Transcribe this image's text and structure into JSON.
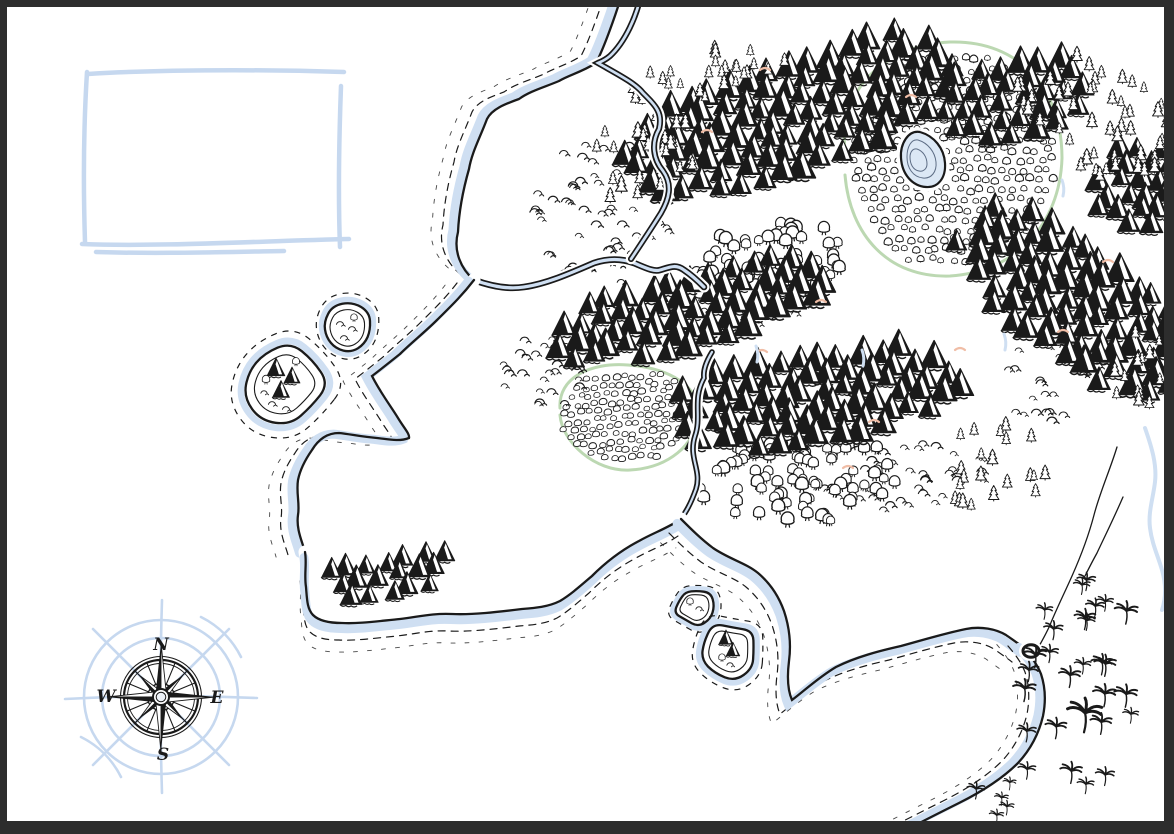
{
  "colors": {
    "ink": "#1a1a1a",
    "paper": "#ffffff",
    "water": "#cfdff2",
    "sketch_blue": "#c6d8ef",
    "green": "#bcd8b2",
    "peach": "#f0bda6",
    "frame": "#2d2d2d",
    "lake_fill": "#dce8f5",
    "lake_line": "#5d6d85"
  },
  "compass": {
    "cx": 161,
    "cy": 697,
    "labels": {
      "n": "N",
      "e": "E",
      "s": "S",
      "w": "W"
    }
  },
  "legend_box": {
    "strokes": [
      "M 88,74 C 150,70 250,69 344,72",
      "M 87,72 C 84,120 83,180 85,242",
      "M 341,86 C 339,140 338,195 340,247",
      "M 82,244 C 160,247 260,241 349,239",
      "M 96,252 C 160,254 220,252 284,251"
    ]
  },
  "map": {
    "green_outlines": [
      "M 845,150 C 838,90 885,45 950,42 C 1020,40 1062,90 1062,158 C 1060,225 1015,272 950,276 C 888,278 850,235 845,175",
      "M 560,408 C 558,378 590,362 628,365 C 668,368 700,385 698,415 C 696,445 668,468 630,470 C 595,472 562,442 560,415"
    ],
    "terrain": [
      {
        "name": "forest-round",
        "glyph": "bush",
        "cx": 952,
        "cy": 160,
        "rx": 103,
        "ry": 110,
        "rot": 0,
        "mode": "grid",
        "su": 11,
        "sv": 10,
        "s": 1,
        "seed": 52
      },
      {
        "name": "boulder-field",
        "glyph": "boulder",
        "cx": 628,
        "cy": 416,
        "rx": 68,
        "ry": 47,
        "rot": -5,
        "mode": "grid",
        "su": 9,
        "sv": 8,
        "s": 1,
        "seed": 51
      },
      {
        "name": "scrub-northwest",
        "glyph": "scrub",
        "cx": 602,
        "cy": 210,
        "rx": 72,
        "ry": 75,
        "rot": 0,
        "mode": "rand",
        "count": 55,
        "s": 1,
        "seed": 41
      },
      {
        "name": "scrub-west",
        "glyph": "scrub",
        "cx": 545,
        "cy": 368,
        "rx": 46,
        "ry": 42,
        "rot": 0,
        "mode": "rand",
        "count": 26,
        "s": 1,
        "seed": 42
      },
      {
        "name": "scrub-south",
        "glyph": "scrub",
        "cx": 905,
        "cy": 478,
        "rx": 85,
        "ry": 34,
        "rot": -8,
        "mode": "rand",
        "count": 40,
        "s": 1,
        "seed": 43
      },
      {
        "name": "scrub-east",
        "glyph": "scrub",
        "cx": 1048,
        "cy": 372,
        "rx": 55,
        "ry": 48,
        "rot": 0,
        "mode": "rand",
        "count": 26,
        "s": 1,
        "seed": 44
      },
      {
        "name": "scrub-mid",
        "glyph": "scrub",
        "cx": 757,
        "cy": 300,
        "rx": 60,
        "ry": 24,
        "rot": -8,
        "mode": "rand",
        "count": 16,
        "s": 1,
        "seed": 45
      },
      {
        "name": "grove-north",
        "glyph": "tree",
        "cx": 762,
        "cy": 262,
        "rx": 88,
        "ry": 38,
        "rot": -8,
        "mode": "rand",
        "count": 55,
        "s": 1.1,
        "seed": 31
      },
      {
        "name": "grove-central",
        "glyph": "tree",
        "cx": 800,
        "cy": 480,
        "rx": 100,
        "ry": 46,
        "rot": -6,
        "mode": "rand",
        "count": 85,
        "s": 1.1,
        "seed": 32
      },
      {
        "name": "range-top",
        "glyph": "mtn",
        "cx": 790,
        "cy": 112,
        "rx": 185,
        "ry": 60,
        "rot": -18,
        "mode": "grid",
        "su": 21,
        "sv": 16,
        "s": 1.5,
        "seed": 11
      },
      {
        "name": "range-top-east",
        "glyph": "mtn",
        "cx": 1012,
        "cy": 93,
        "rx": 82,
        "ry": 42,
        "rot": -12,
        "mode": "grid",
        "su": 21,
        "sv": 16,
        "s": 1.4,
        "seed": 12
      },
      {
        "name": "range-mid",
        "glyph": "mtn",
        "cx": 688,
        "cy": 306,
        "rx": 148,
        "ry": 40,
        "rot": -14,
        "mode": "grid",
        "su": 21,
        "sv": 15,
        "s": 1.5,
        "seed": 13
      },
      {
        "name": "range-mid-south",
        "glyph": "mtn",
        "cx": 818,
        "cy": 392,
        "rx": 152,
        "ry": 48,
        "rot": -8,
        "mode": "grid",
        "su": 21,
        "sv": 15,
        "s": 1.5,
        "seed": 14
      },
      {
        "name": "range-east",
        "glyph": "mtn",
        "cx": 1082,
        "cy": 300,
        "rx": 142,
        "ry": 60,
        "rot": 35,
        "mode": "grid",
        "su": 21,
        "sv": 16,
        "s": 1.5,
        "seed": 15
      },
      {
        "name": "range-east-corner",
        "glyph": "mtn",
        "cx": 1140,
        "cy": 182,
        "rx": 52,
        "ry": 48,
        "rot": 0,
        "mode": "grid",
        "su": 20,
        "sv": 15,
        "s": 1.35,
        "seed": 16
      },
      {
        "name": "range-southwest",
        "glyph": "mtn",
        "cx": 388,
        "cy": 572,
        "rx": 66,
        "ry": 25,
        "rot": -10,
        "mode": "grid",
        "su": 19,
        "sv": 14,
        "s": 1.2,
        "seed": 17
      },
      {
        "name": "pines-west",
        "glyph": "pine",
        "cx": 645,
        "cy": 155,
        "rx": 62,
        "ry": 45,
        "rot": -18,
        "mode": "rand",
        "count": 26,
        "s": 0.9,
        "seed": 21
      },
      {
        "name": "pines-top",
        "glyph": "pine",
        "cx": 705,
        "cy": 72,
        "rx": 95,
        "ry": 26,
        "rot": -14,
        "mode": "rand",
        "count": 26,
        "s": 0.8,
        "seed": 22
      },
      {
        "name": "pines-northeast",
        "glyph": "pine",
        "cx": 1095,
        "cy": 115,
        "rx": 85,
        "ry": 58,
        "rot": 18,
        "mode": "rand",
        "count": 48,
        "s": 0.85,
        "seed": 23
      },
      {
        "name": "pines-east-south",
        "glyph": "pine",
        "cx": 995,
        "cy": 465,
        "rx": 60,
        "ry": 42,
        "rot": -8,
        "mode": "rand",
        "count": 22,
        "s": 0.8,
        "seed": 24
      },
      {
        "name": "pines-right-edge",
        "glyph": "pine",
        "cx": 1150,
        "cy": 368,
        "rx": 35,
        "ry": 55,
        "rot": 20,
        "mode": "rand",
        "count": 14,
        "s": 0.8,
        "seed": 25
      },
      {
        "name": "palm-grove",
        "glyph": "palm",
        "cx": 1082,
        "cy": 688,
        "rx": 62,
        "ry": 112,
        "rot": 6,
        "mode": "rand",
        "count": 26,
        "s": 1,
        "seed": 61,
        "post": true
      },
      {
        "name": "palm-outliers",
        "glyph": "palm",
        "cx": 1010,
        "cy": 795,
        "rx": 45,
        "ry": 28,
        "rot": 0,
        "mode": "rand",
        "count": 6,
        "s": 0.8,
        "seed": 62,
        "post": true
      },
      {
        "name": "palm-large",
        "glyph": "palm",
        "cx": 1085,
        "cy": 712,
        "rx": 3,
        "ry": 3,
        "rot": 0,
        "mode": "rand",
        "count": 1,
        "s": 2.0,
        "seed": 63,
        "post": true
      }
    ],
    "waters": [
      {
        "name": "coast-northwest",
        "kind": "coast",
        "wdx": -9,
        "wdy": -4,
        "hdx": -15,
        "hdy": -7,
        "d": "M 622,-6 C 616,14 604,48 596,63 C 582,72 569,75 559,81 C 545,87 530,91 519,99 C 505,104 492,109 487,119 C 479,140 472,152 469,169 C 463,190 459,211 458,232 C 453,251 461,269 474,280"
      },
      {
        "name": "river-inlet",
        "kind": "river",
        "w": 4,
        "d": "M 474,280 C 496,288 511,289 524,287 C 546,284 571,273 594,263 C 609,258 623,259 634,263 C 646,268 654,272 660,270 C 670,267 676,264 684,270 C 693,276 699,282 704,287"
      },
      {
        "name": "river-north",
        "kind": "river",
        "w": 3.5,
        "d": "M 641,-6 C 637,16 625,42 610,56 C 604,61 600,62 598,63 C 619,75 635,83 643,93 C 656,106 663,113 659,129 C 651,143 653,159 663,171 C 673,185 669,199 661,213 C 651,229 641,244 631,259"
      },
      {
        "name": "river-gap",
        "kind": "river",
        "w": 3,
        "d": "M 712,352 C 706,362 703,370 704,378 C 692,400 702,416 695,436 C 688,458 702,470 696,489 C 690,506 685,513 681,519"
      },
      {
        "name": "coast-central-west",
        "kind": "coast",
        "wdx": -10,
        "wdy": 2,
        "hdx": -17,
        "hdy": 3,
        "d": "M 474,280 C 461,297 448,309 437,320 C 425,332 411,343 400,354 C 390,362 380,370 372,376 C 380,392 390,405 398,418 C 404,428 410,434 409,438 C 399,442 387,439 377,438 C 362,437 350,434 339,433 C 327,433 318,440 312,450 C 305,460 300,470 298,480 C 296,493 300,504 298,515 C 296,529 302,541 305,552"
      },
      {
        "name": "coast-central-south",
        "kind": "coast",
        "wdx": -2,
        "wdy": 10,
        "hdx": -3,
        "hdy": 17,
        "d": "M 305,552 C 307,563 304,575 306,587 C 307,599 307,609 313,615 C 319,621 329,623 342,623 C 358,624 379,621 400,619 C 418,617 432,613 452,614 C 472,615 498,612 522,609 C 535,608 548,607 560,601 C 570,595 578,588 592,576 C 603,565 618,552 639,541 C 653,533 668,528 681,519"
      },
      {
        "name": "channel-southeast",
        "kind": "coast",
        "wdx": -7,
        "wdy": 8,
        "hdx": -12,
        "hdy": 14,
        "d": "M 681,519 C 691,529 701,539 713,548 C 729,559 746,563 758,573 C 771,584 779,597 784,611 C 790,629 791,646 789,661 C 787,677 788,691 792,700 C 804,691 819,677 836,667 C 856,657 879,651 901,646 C 923,640 946,633 966,629 C 981,626 996,629 1006,635 C 1013,640 1019,644 1024,648"
      },
      {
        "name": "coast-southeast",
        "kind": "coast",
        "wdx": -9,
        "wdy": -1,
        "hdx": -16,
        "hdy": -2,
        "d": "M 1024,648 C 1031,656 1037,664 1041,674 C 1045,686 1046,701 1043,716 C 1039,733 1031,749 1018,763 C 1003,778 983,791 959,803 C 941,812 923,821 908,829 C 904,832 901,834 899,835"
      },
      {
        "name": "stream-east-1",
        "kind": "stream",
        "d": "M 1117,447 C 1110,470 1100,492 1094,515 C 1088,538 1080,558 1072,576 C 1064,594 1056,610 1050,625 C 1046,634 1042,641 1038,648"
      },
      {
        "name": "stream-east-2",
        "kind": "stream",
        "d": "M 1123,497 C 1113,520 1104,538 1097,553 C 1092,562 1088,570 1085,576"
      },
      {
        "name": "stream-blue",
        "kind": "bluestream",
        "d": "M 1145,428 C 1152,448 1157,465 1155,482 C 1153,499 1148,512 1150,528 C 1152,544 1158,556 1162,570 C 1166,584 1166,598 1162,610"
      }
    ],
    "lake": {
      "d": "M 920,132 C 934,136 944,148 945,163 C 946,178 938,188 926,187 C 912,186 902,174 901,158 C 900,144 908,130 920,132",
      "inner": [
        "M 918,140 C 928,143 935,152 936,162 C 937,172 931,179 923,178 C 913,177 907,168 907,157 C 907,147 911,139 918,140",
        "M 917,149 C 923,151 927,157 927,164 C 927,169 923,172 919,171 C 913,170 910,164 910,157 C 910,152 913,148 917,149"
      ]
    },
    "pond": {
      "cx": 1031,
      "cy": 651,
      "rx": 8,
      "ry": 6.2
    },
    "islands": [
      {
        "name": "island-nw-large",
        "cx": 283,
        "cy": 384,
        "r": 40,
        "seed": 71,
        "content": [
          {
            "g": "mtn",
            "x": 276,
            "y": 368,
            "s": 1.1
          },
          {
            "g": "mtn",
            "x": 292,
            "y": 376,
            "s": 1.0
          },
          {
            "g": "mtn",
            "x": 281,
            "y": 390,
            "s": 1.05
          },
          {
            "g": "tree",
            "x": 266,
            "y": 380,
            "s": 0.8
          },
          {
            "g": "tree",
            "x": 296,
            "y": 362,
            "s": 0.75
          },
          {
            "g": "scrub",
            "x": 272,
            "y": 403,
            "s": 0.9
          },
          {
            "g": "scrub",
            "x": 286,
            "y": 408,
            "s": 0.9
          },
          {
            "g": "scrub",
            "x": 264,
            "y": 392,
            "s": 0.8
          }
        ]
      },
      {
        "name": "island-nw-small",
        "cx": 347,
        "cy": 330,
        "r": 25,
        "seed": 72,
        "content": [
          {
            "g": "scrub",
            "x": 340,
            "y": 323,
            "s": 0.9
          },
          {
            "g": "scrub",
            "x": 352,
            "y": 328,
            "s": 0.9
          },
          {
            "g": "scrub",
            "x": 344,
            "y": 337,
            "s": 0.9
          },
          {
            "g": "tree",
            "x": 354,
            "y": 318,
            "s": 0.7
          }
        ]
      },
      {
        "name": "island-south-small",
        "cx": 694,
        "cy": 606,
        "r": 18,
        "seed": 73,
        "content": [
          {
            "g": "tree",
            "x": 690,
            "y": 602,
            "s": 0.7
          },
          {
            "g": "scrub",
            "x": 699,
            "y": 608,
            "s": 0.8
          }
        ]
      },
      {
        "name": "island-south-large",
        "cx": 729,
        "cy": 650,
        "r": 27,
        "seed": 74,
        "content": [
          {
            "g": "mtn",
            "x": 726,
            "y": 638,
            "s": 0.9
          },
          {
            "g": "mtn",
            "x": 733,
            "y": 650,
            "s": 0.85
          },
          {
            "g": "tree",
            "x": 722,
            "y": 658,
            "s": 0.7
          },
          {
            "g": "scrub",
            "x": 730,
            "y": 664,
            "s": 0.8
          }
        ]
      }
    ],
    "accents": {
      "peach": [
        [
          757,
          352
        ],
        [
          816,
          302
        ],
        [
          869,
          422
        ],
        [
          1058,
          332
        ],
        [
          702,
          132
        ],
        [
          906,
          97
        ],
        [
          843,
          468
        ],
        [
          1103,
          262
        ],
        [
          760,
          70
        ],
        [
          955,
          350
        ]
      ],
      "blue": [
        [
          862,
          350
        ],
        [
          1004,
          334
        ],
        [
          1062,
          180
        ],
        [
          756,
          346
        ]
      ]
    }
  }
}
